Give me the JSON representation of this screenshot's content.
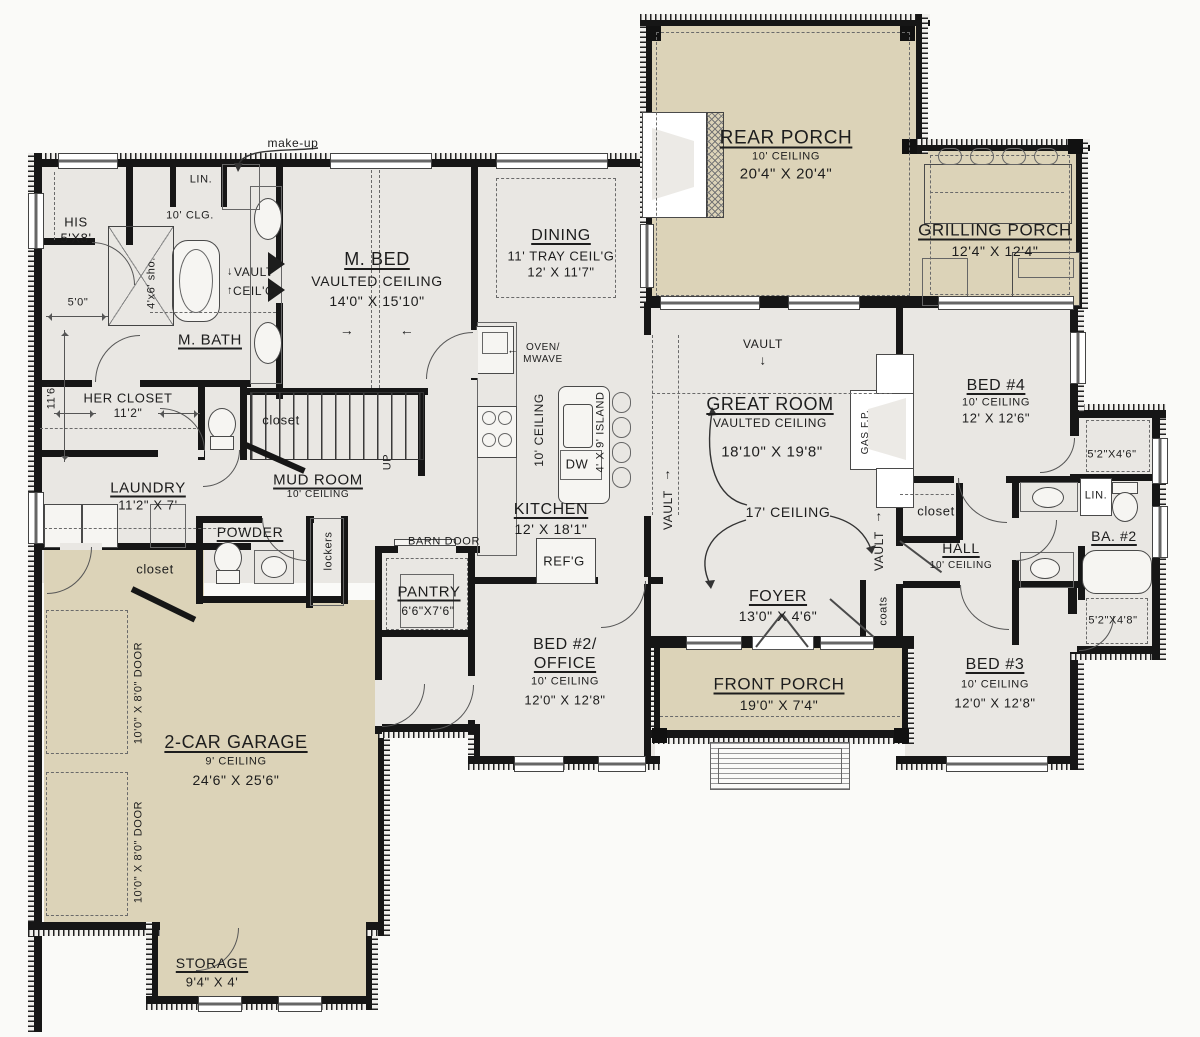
{
  "meta": {
    "type": "architectural-floor-plan",
    "colors": {
      "wall": "#161616",
      "floor": "#e9e7e3",
      "porch": "#dcd3b8",
      "text": "#1d1d1d"
    }
  },
  "labels": [
    {
      "n": "room-rear-porch",
      "t": "REAR PORCH",
      "x": 786,
      "y": 138,
      "s": 19,
      "u": 1
    },
    {
      "n": "rear-porch-ceiling",
      "t": "10' CEILING",
      "x": 786,
      "y": 157,
      "s": 11
    },
    {
      "n": "rear-porch-dim",
      "t": "20'4\" X 20'4\"",
      "x": 786,
      "y": 174,
      "s": 15
    },
    {
      "n": "room-grilling-porch",
      "t": "GRILLING PORCH",
      "x": 995,
      "y": 230,
      "s": 17,
      "u": 1
    },
    {
      "n": "grilling-porch-dim",
      "t": "12'4\" X 12'4\"",
      "x": 995,
      "y": 251,
      "s": 14
    },
    {
      "n": "room-master-bed",
      "t": "M. BED",
      "x": 377,
      "y": 259,
      "s": 18,
      "u": 1
    },
    {
      "n": "master-bed-ceiling",
      "t": "VAULTED CEILING",
      "x": 377,
      "y": 281,
      "s": 14
    },
    {
      "n": "master-bed-dim",
      "t": "14'0\" X 15'10\"",
      "x": 377,
      "y": 301,
      "s": 14
    },
    {
      "n": "master-bed-arrow-right",
      "t": "→",
      "x": 347,
      "y": 330,
      "s": 14
    },
    {
      "n": "master-bed-arrow-left",
      "t": "←",
      "x": 407,
      "y": 330,
      "s": 14
    },
    {
      "n": "room-dining",
      "t": "DINING",
      "x": 561,
      "y": 236,
      "s": 16,
      "u": 1
    },
    {
      "n": "dining-ceiling",
      "t": "11' TRAY CEIL'G",
      "x": 561,
      "y": 256,
      "s": 13
    },
    {
      "n": "dining-dim",
      "t": "12' X 11'7\"",
      "x": 561,
      "y": 272,
      "s": 13
    },
    {
      "n": "room-great-room",
      "t": "GREAT ROOM",
      "x": 770,
      "y": 404,
      "s": 18,
      "u": 1
    },
    {
      "n": "great-room-ceiling",
      "t": "VAULTED CEILING",
      "x": 770,
      "y": 423,
      "s": 12
    },
    {
      "n": "great-room-dim",
      "t": "18'10\" X 19'8\"",
      "x": 772,
      "y": 452,
      "s": 15
    },
    {
      "n": "great-room-vault",
      "t": "VAULT",
      "x": 763,
      "y": 344,
      "s": 12
    },
    {
      "n": "great-room-vault-arrow",
      "t": "↓",
      "x": 763,
      "y": 360,
      "s": 13
    },
    {
      "n": "kitchen-vault",
      "t": "VAULT",
      "x": 668,
      "y": 510,
      "s": 12,
      "r": -90
    },
    {
      "n": "kitchen-vault-arrow",
      "t": "↑",
      "x": 668,
      "y": 474,
      "s": 13
    },
    {
      "n": "hall-vault",
      "t": "VAULT",
      "x": 879,
      "y": 551,
      "s": 12,
      "r": -90
    },
    {
      "n": "hall-vault-arrow",
      "t": "↑",
      "x": 879,
      "y": 516,
      "s": 13
    },
    {
      "n": "gas-fireplace-label",
      "t": "GAS F.P.",
      "x": 866,
      "y": 432,
      "s": 10,
      "r": -90
    },
    {
      "n": "ceiling-17",
      "t": "17' CEILING",
      "x": 788,
      "y": 512,
      "s": 14
    },
    {
      "n": "room-foyer",
      "t": "FOYER",
      "x": 778,
      "y": 597,
      "s": 16,
      "u": 1
    },
    {
      "n": "foyer-dim",
      "t": "13'0\" X 4'6\"",
      "x": 778,
      "y": 616,
      "s": 14
    },
    {
      "n": "room-front-porch",
      "t": "FRONT PORCH",
      "x": 779,
      "y": 684,
      "s": 17,
      "u": 1
    },
    {
      "n": "front-porch-dim",
      "t": "19'0\" X 7'4\"",
      "x": 779,
      "y": 705,
      "s": 14
    },
    {
      "n": "room-bed4",
      "t": "BED #4",
      "x": 996,
      "y": 386,
      "s": 16,
      "u": 1
    },
    {
      "n": "bed4-ceiling",
      "t": "10' CEILING",
      "x": 996,
      "y": 403,
      "s": 11
    },
    {
      "n": "bed4-dim",
      "t": "12' X 12'6\"",
      "x": 996,
      "y": 418,
      "s": 13
    },
    {
      "n": "hall-closet-label",
      "t": "closet",
      "x": 936,
      "y": 511,
      "s": 13
    },
    {
      "n": "room-hall",
      "t": "HALL",
      "x": 961,
      "y": 548,
      "s": 14,
      "u": 1
    },
    {
      "n": "hall-ceiling",
      "t": "10' CEILING",
      "x": 961,
      "y": 566,
      "s": 10
    },
    {
      "n": "ba2-linen",
      "t": "LIN.",
      "x": 1096,
      "y": 496,
      "s": 11
    },
    {
      "n": "room-ba2",
      "t": "BA. #2",
      "x": 1114,
      "y": 536,
      "s": 14,
      "u": 1
    },
    {
      "n": "bed4-closet-dim",
      "t": "5'2\"X4'6\"",
      "x": 1112,
      "y": 455,
      "s": 11
    },
    {
      "n": "bed3-closet-dim",
      "t": "5'2\"X4'8\"",
      "x": 1113,
      "y": 621,
      "s": 11
    },
    {
      "n": "coats-closet-label",
      "t": "coats",
      "x": 884,
      "y": 611,
      "s": 11,
      "r": -90
    },
    {
      "n": "room-bed3",
      "t": "BED #3",
      "x": 995,
      "y": 665,
      "s": 16,
      "u": 1
    },
    {
      "n": "bed3-ceiling",
      "t": "10' CEILING",
      "x": 995,
      "y": 685,
      "s": 11
    },
    {
      "n": "bed3-dim",
      "t": "12'0\" X 12'8\"",
      "x": 995,
      "y": 703,
      "s": 13
    },
    {
      "n": "room-bed2-line1",
      "t": "BED #2/",
      "x": 565,
      "y": 645,
      "s": 16
    },
    {
      "n": "room-bed2-line2",
      "t": "OFFICE",
      "x": 565,
      "y": 664,
      "s": 16,
      "u": 1
    },
    {
      "n": "bed2-ceiling",
      "t": "10' CEILING",
      "x": 565,
      "y": 682,
      "s": 11
    },
    {
      "n": "bed2-dim",
      "t": "12'0\" X 12'8\"",
      "x": 565,
      "y": 700,
      "s": 13
    },
    {
      "n": "room-kitchen",
      "t": "KITCHEN",
      "x": 551,
      "y": 510,
      "s": 16,
      "u": 1
    },
    {
      "n": "kitchen-dim",
      "t": "12' X 18'1\"",
      "x": 551,
      "y": 529,
      "s": 14
    },
    {
      "n": "kitchen-ceiling",
      "t": "10' CEILING",
      "x": 539,
      "y": 430,
      "s": 12,
      "r": -90
    },
    {
      "n": "island-dim",
      "t": "4' X 9' ISLAND",
      "x": 601,
      "y": 432,
      "s": 11,
      "r": -90
    },
    {
      "n": "dishwasher-label",
      "t": "DW",
      "x": 577,
      "y": 464,
      "s": 13
    },
    {
      "n": "refrigerator-label",
      "t": "REF'G",
      "x": 564,
      "y": 561,
      "s": 13
    },
    {
      "n": "oven-line1",
      "t": "OVEN/",
      "x": 543,
      "y": 348,
      "s": 10
    },
    {
      "n": "oven-line2",
      "t": "MWAVE",
      "x": 543,
      "y": 360,
      "s": 10
    },
    {
      "n": "oven-arrow",
      "t": "←",
      "x": 513,
      "y": 351,
      "s": 11
    },
    {
      "n": "room-mud",
      "t": "MUD ROOM",
      "x": 318,
      "y": 480,
      "s": 15,
      "u": 1
    },
    {
      "n": "mud-ceiling",
      "t": "10' CEILING",
      "x": 318,
      "y": 495,
      "s": 10
    },
    {
      "n": "stairs-closet-label",
      "t": "closet",
      "x": 281,
      "y": 420,
      "s": 13
    },
    {
      "n": "stairs-up",
      "t": "UP",
      "x": 388,
      "y": 462,
      "s": 11,
      "r": -90
    },
    {
      "n": "room-powder",
      "t": "POWDER",
      "x": 250,
      "y": 532,
      "s": 14,
      "u": 1
    },
    {
      "n": "lockers-label",
      "t": "lockers",
      "x": 329,
      "y": 551,
      "s": 11,
      "r": -90
    },
    {
      "n": "barn-door-label",
      "t": "BARN DOOR",
      "x": 444,
      "y": 542,
      "s": 11
    },
    {
      "n": "room-pantry",
      "t": "PANTRY",
      "x": 429,
      "y": 592,
      "s": 15,
      "u": 1
    },
    {
      "n": "pantry-dim",
      "t": "6'6\"X7'6\"",
      "x": 428,
      "y": 611,
      "s": 12
    },
    {
      "n": "room-laundry",
      "t": "LAUNDRY",
      "x": 148,
      "y": 488,
      "s": 15,
      "u": 1
    },
    {
      "n": "laundry-dim",
      "t": "11'2\" X 7'",
      "x": 148,
      "y": 505,
      "s": 13
    },
    {
      "n": "garage-closet-label",
      "t": "closet",
      "x": 155,
      "y": 569,
      "s": 13
    },
    {
      "n": "her-closet-label",
      "t": "HER CLOSET",
      "x": 128,
      "y": 398,
      "s": 13
    },
    {
      "n": "her-closet-dim",
      "t": "11'2\"",
      "x": 128,
      "y": 413,
      "s": 12
    },
    {
      "n": "room-mbath",
      "t": "M. BATH",
      "x": 210,
      "y": 340,
      "s": 15,
      "u": 1
    },
    {
      "n": "mbath-vault-line1",
      "t": "VAULT",
      "x": 254,
      "y": 272,
      "s": 12
    },
    {
      "n": "mbath-vault-line2",
      "t": "CEIL'G",
      "x": 254,
      "y": 291,
      "s": 12
    },
    {
      "n": "mbath-vault-arrow-down",
      "t": "↓",
      "x": 230,
      "y": 272,
      "s": 11
    },
    {
      "n": "mbath-vault-arrow-up",
      "t": "↑",
      "x": 230,
      "y": 291,
      "s": 11
    },
    {
      "n": "mbath-ceiling",
      "t": "10' CLG.",
      "x": 190,
      "y": 216,
      "s": 11
    },
    {
      "n": "shower-dim",
      "t": "4'x6' sho.",
      "x": 152,
      "y": 283,
      "s": 11,
      "r": -90
    },
    {
      "n": "his-closet-line1",
      "t": "HIS",
      "x": 76,
      "y": 222,
      "s": 13
    },
    {
      "n": "his-closet-line2",
      "t": "5'X8'",
      "x": 76,
      "y": 238,
      "s": 13
    },
    {
      "n": "linen-top",
      "t": "LIN.",
      "x": 201,
      "y": 180,
      "s": 11
    },
    {
      "n": "makeup-label",
      "t": "make-up",
      "x": 293,
      "y": 143,
      "s": 12
    },
    {
      "n": "dim-5-0",
      "t": "5'0\"",
      "x": 78,
      "y": 303,
      "s": 11
    },
    {
      "n": "dim-11-6",
      "t": "11'6\"",
      "x": 52,
      "y": 396,
      "s": 11,
      "r": -90
    },
    {
      "n": "room-garage",
      "t": "2-CAR GARAGE",
      "x": 236,
      "y": 742,
      "s": 18,
      "u": 1
    },
    {
      "n": "garage-ceiling",
      "t": "9' CEILING",
      "x": 236,
      "y": 762,
      "s": 11
    },
    {
      "n": "garage-dim",
      "t": "24'6\" X 25'6\"",
      "x": 236,
      "y": 780,
      "s": 14
    },
    {
      "n": "garage-door1",
      "t": "10'0\" X 8'0\" DOOR",
      "x": 139,
      "y": 693,
      "s": 11,
      "r": -90
    },
    {
      "n": "garage-door2",
      "t": "10'0\" X 8'0\" DOOR",
      "x": 139,
      "y": 852,
      "s": 11,
      "r": -90
    },
    {
      "n": "room-storage",
      "t": "STORAGE",
      "x": 212,
      "y": 963,
      "s": 14,
      "u": 1
    },
    {
      "n": "storage-dim",
      "t": "9'4\" X 4'",
      "x": 212,
      "y": 982,
      "s": 13
    }
  ]
}
